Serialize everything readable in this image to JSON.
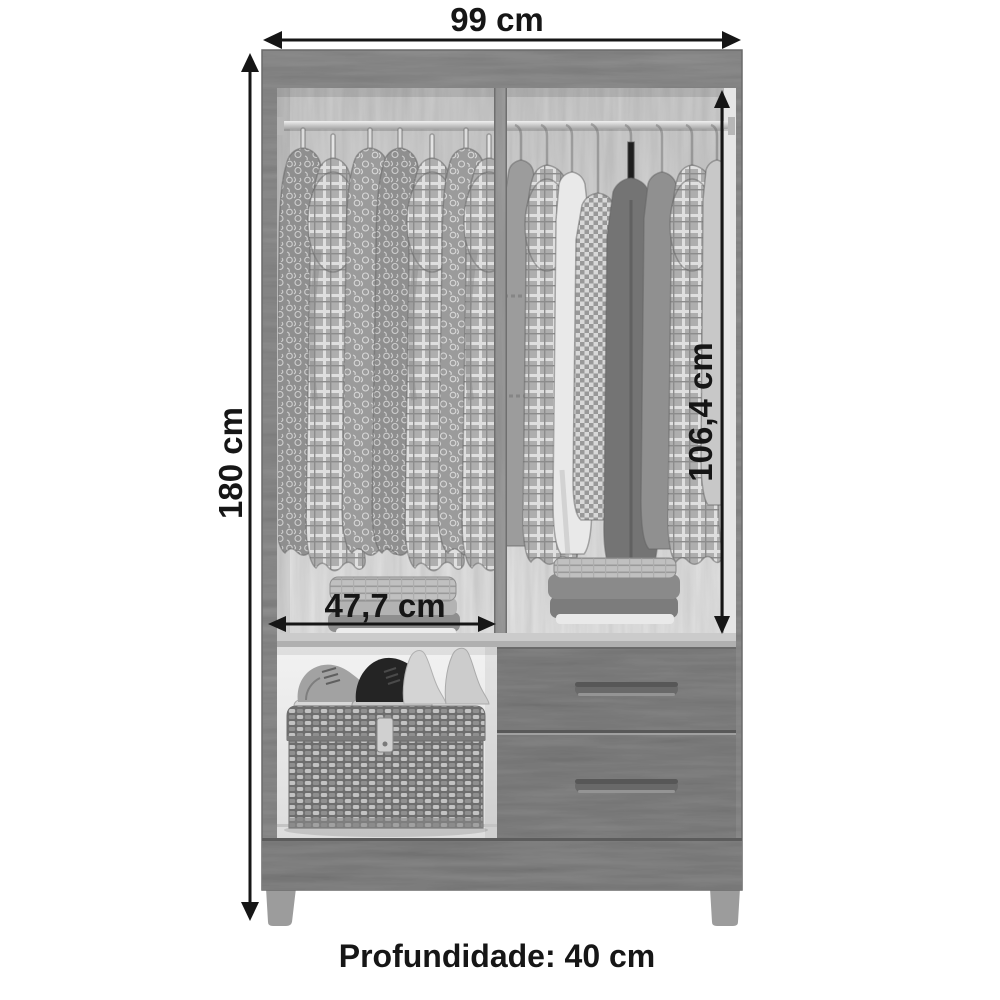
{
  "diagram": {
    "product": "wardrobe",
    "labels": {
      "width": "99 cm",
      "height": "180 cm",
      "inner_height": "106,4 cm",
      "inner_width": "47,7 cm",
      "depth": "Profundidade: 40 cm"
    },
    "values": {
      "width_cm": 99,
      "height_cm": 180,
      "inner_height_cm": "106,4",
      "inner_width_cm": "47,7",
      "depth_cm": 40
    },
    "colors": {
      "background": "#ffffff",
      "dimension_lines": "#161616",
      "frame_wood": "#8d8d8d",
      "interior_panel": "#d6d6d6",
      "divider_wood": "#9a9a9a",
      "drawer_front": "#828282",
      "base_wood": "#848484",
      "compartment": "#efefef"
    }
  }
}
